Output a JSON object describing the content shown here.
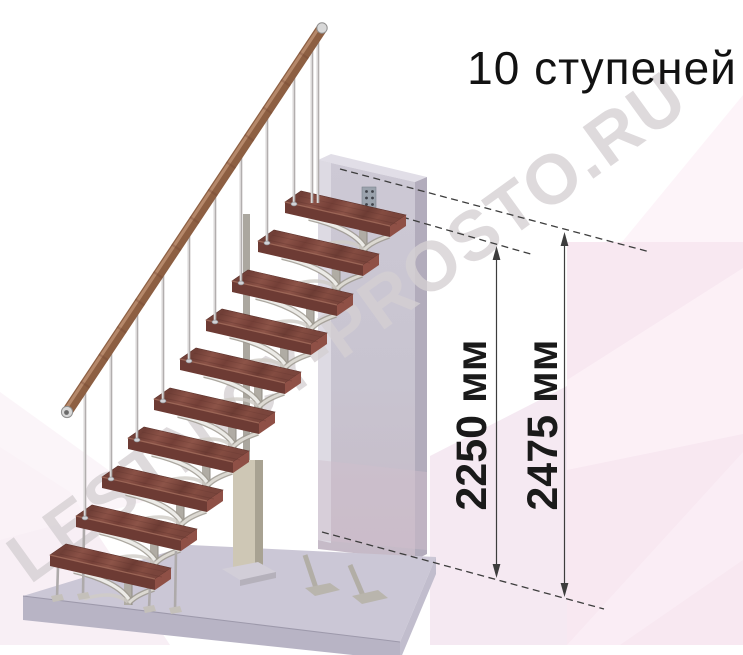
{
  "header": {
    "title": "10 ступеней"
  },
  "watermark": {
    "text": "LESTNICY-PROSTO.RU"
  },
  "dims": {
    "items": [
      {
        "label": "2250 мм",
        "value_mm": 2250
      },
      {
        "label": "2475 мм",
        "value_mm": 2475
      }
    ]
  },
  "diagram": {
    "type": "staircase-elevation",
    "steps_count": 10
  },
  "colors": {
    "wood_tread": "#7c4a42",
    "tread_front": "#6d3b34",
    "tread_end": "#8f5046",
    "handrail": "#8d5f49",
    "metal_frame": "#b0aca4",
    "wall": "#c8c4d0",
    "slab": "#cbc7d6",
    "background_pink": "#f8e8f1",
    "dimension_line": "#3d3d3d",
    "text": "#121212",
    "watermark_gray": "#d5d0d3"
  },
  "scene": {
    "steps": [
      [
        50,
        555
      ],
      [
        76,
        516
      ],
      [
        102,
        477
      ],
      [
        128,
        438
      ],
      [
        154,
        399
      ],
      [
        180,
        359
      ],
      [
        206,
        320
      ],
      [
        232,
        281
      ],
      [
        258,
        241
      ],
      [
        285,
        202
      ]
    ],
    "rail": {
      "x1": 67,
      "y1": 412,
      "x2": 322,
      "y2": 28
    },
    "baluster_offset": 9,
    "extra_rods": [
      [
        312,
        49,
        203
      ],
      [
        318,
        40,
        203
      ]
    ],
    "rail_ticks": 13
  }
}
